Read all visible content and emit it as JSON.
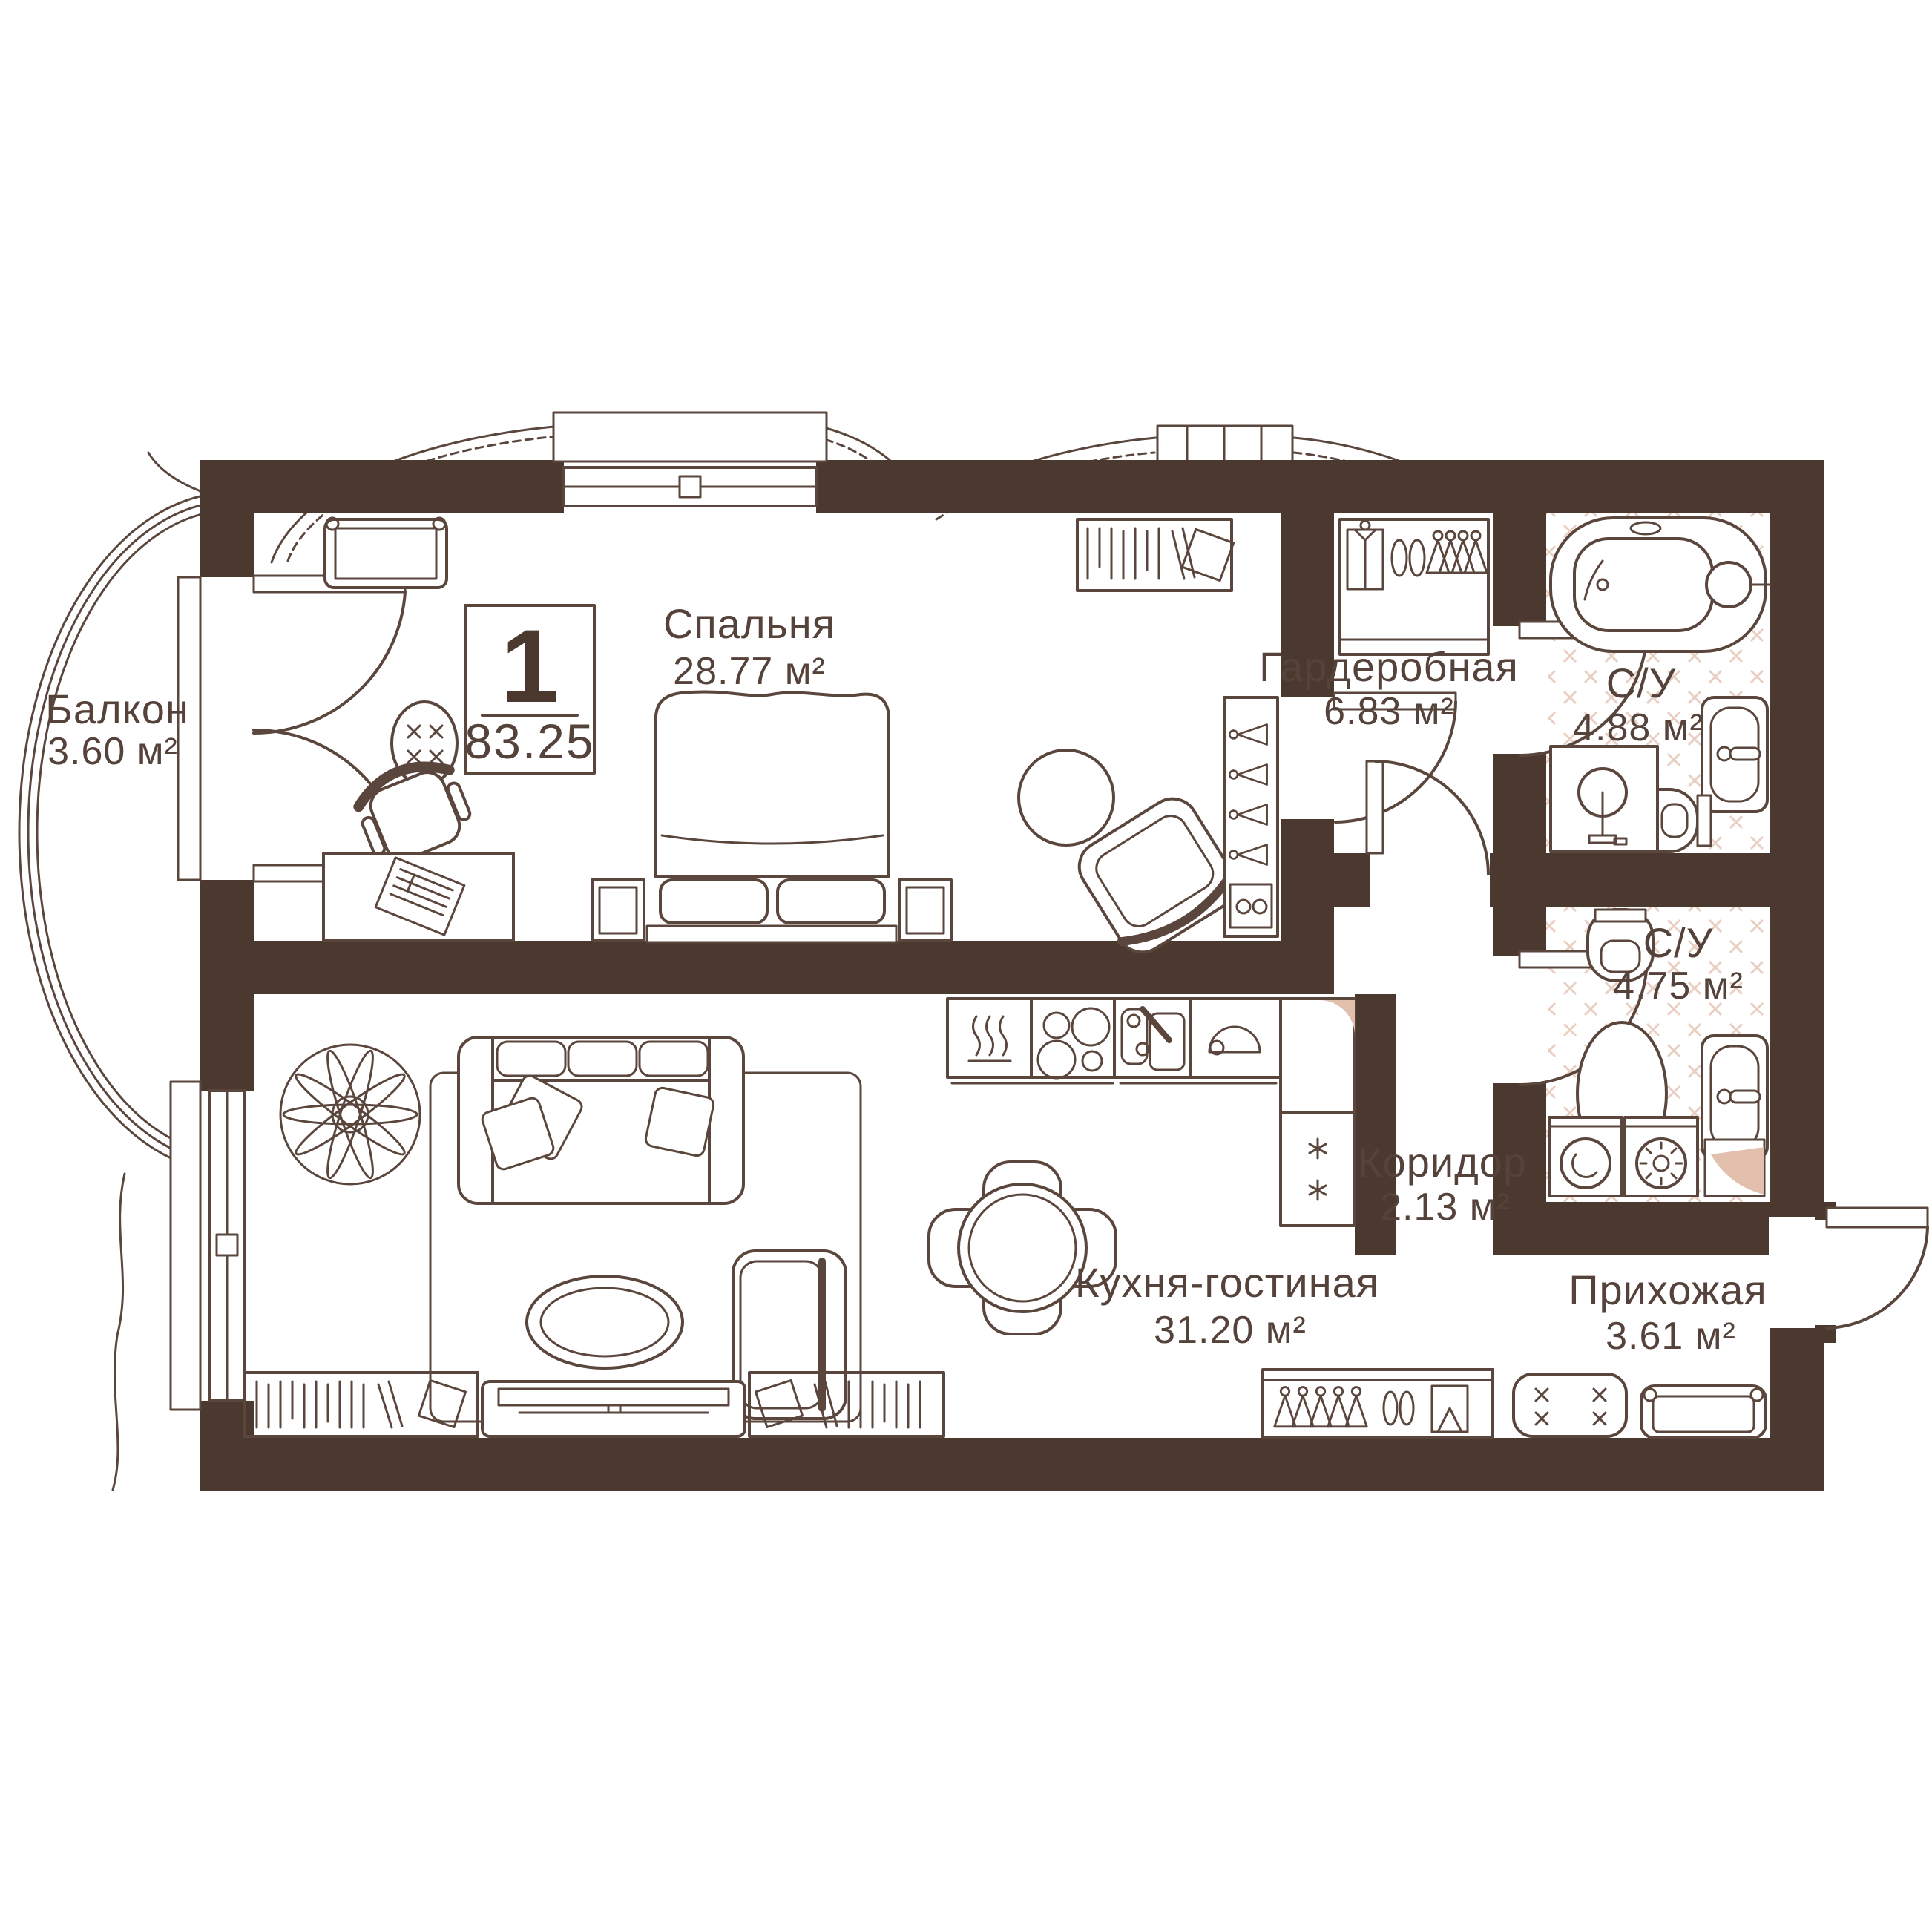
{
  "plan": {
    "info_box": {
      "rooms_count": "1",
      "total_area": "83.25"
    },
    "rooms": [
      {
        "id": "balcony",
        "name": "Балкон",
        "area": "3.60 м²"
      },
      {
        "id": "bedroom",
        "name": "Спальня",
        "area": "28.77 м²"
      },
      {
        "id": "wardrobe",
        "name": "Гардеробная",
        "area": "6.83 м²"
      },
      {
        "id": "bathroom_1",
        "name": "С/У",
        "area": "4.88 м²"
      },
      {
        "id": "bathroom_2",
        "name": "С/У",
        "area": "4.75 м²"
      },
      {
        "id": "corridor",
        "name": "Коридор",
        "area": "2.13 м²"
      },
      {
        "id": "kitchen_living",
        "name": "Кухня-гостиная",
        "area": "31.20 м²"
      },
      {
        "id": "hallway",
        "name": "Прихожая",
        "area": "3.61 м²"
      }
    ],
    "colors": {
      "wall": "#4b3930",
      "line": "#5a463c",
      "text": "#55423a",
      "tile": "#e8cfc2",
      "vent_wedge": "#e3bfae",
      "background": "#ffffff"
    },
    "icons": [
      "bathtub-icon",
      "shower-icon",
      "sink-icon",
      "toilet-icon",
      "washer-icon",
      "dryer-icon",
      "stove-icon",
      "cooker-hood-icon",
      "kitchen-sink-icon",
      "dish-icon",
      "fridge-icon",
      "bed-icon",
      "pillow-icon",
      "nightstand-icon",
      "sofa-icon",
      "armchair-icon",
      "office-chair-icon",
      "desk-icon",
      "laptop-icon",
      "stool-icon",
      "dresser-icon",
      "plant-icon",
      "dining-table-icon",
      "tv-console-icon",
      "bookshelf-icon",
      "hanger-icon",
      "shirt-icon",
      "shoes-icon",
      "ottoman-icon",
      "bench-icon",
      "door-swing-icon",
      "window-icon",
      "balcony-glazing-icon"
    ]
  }
}
